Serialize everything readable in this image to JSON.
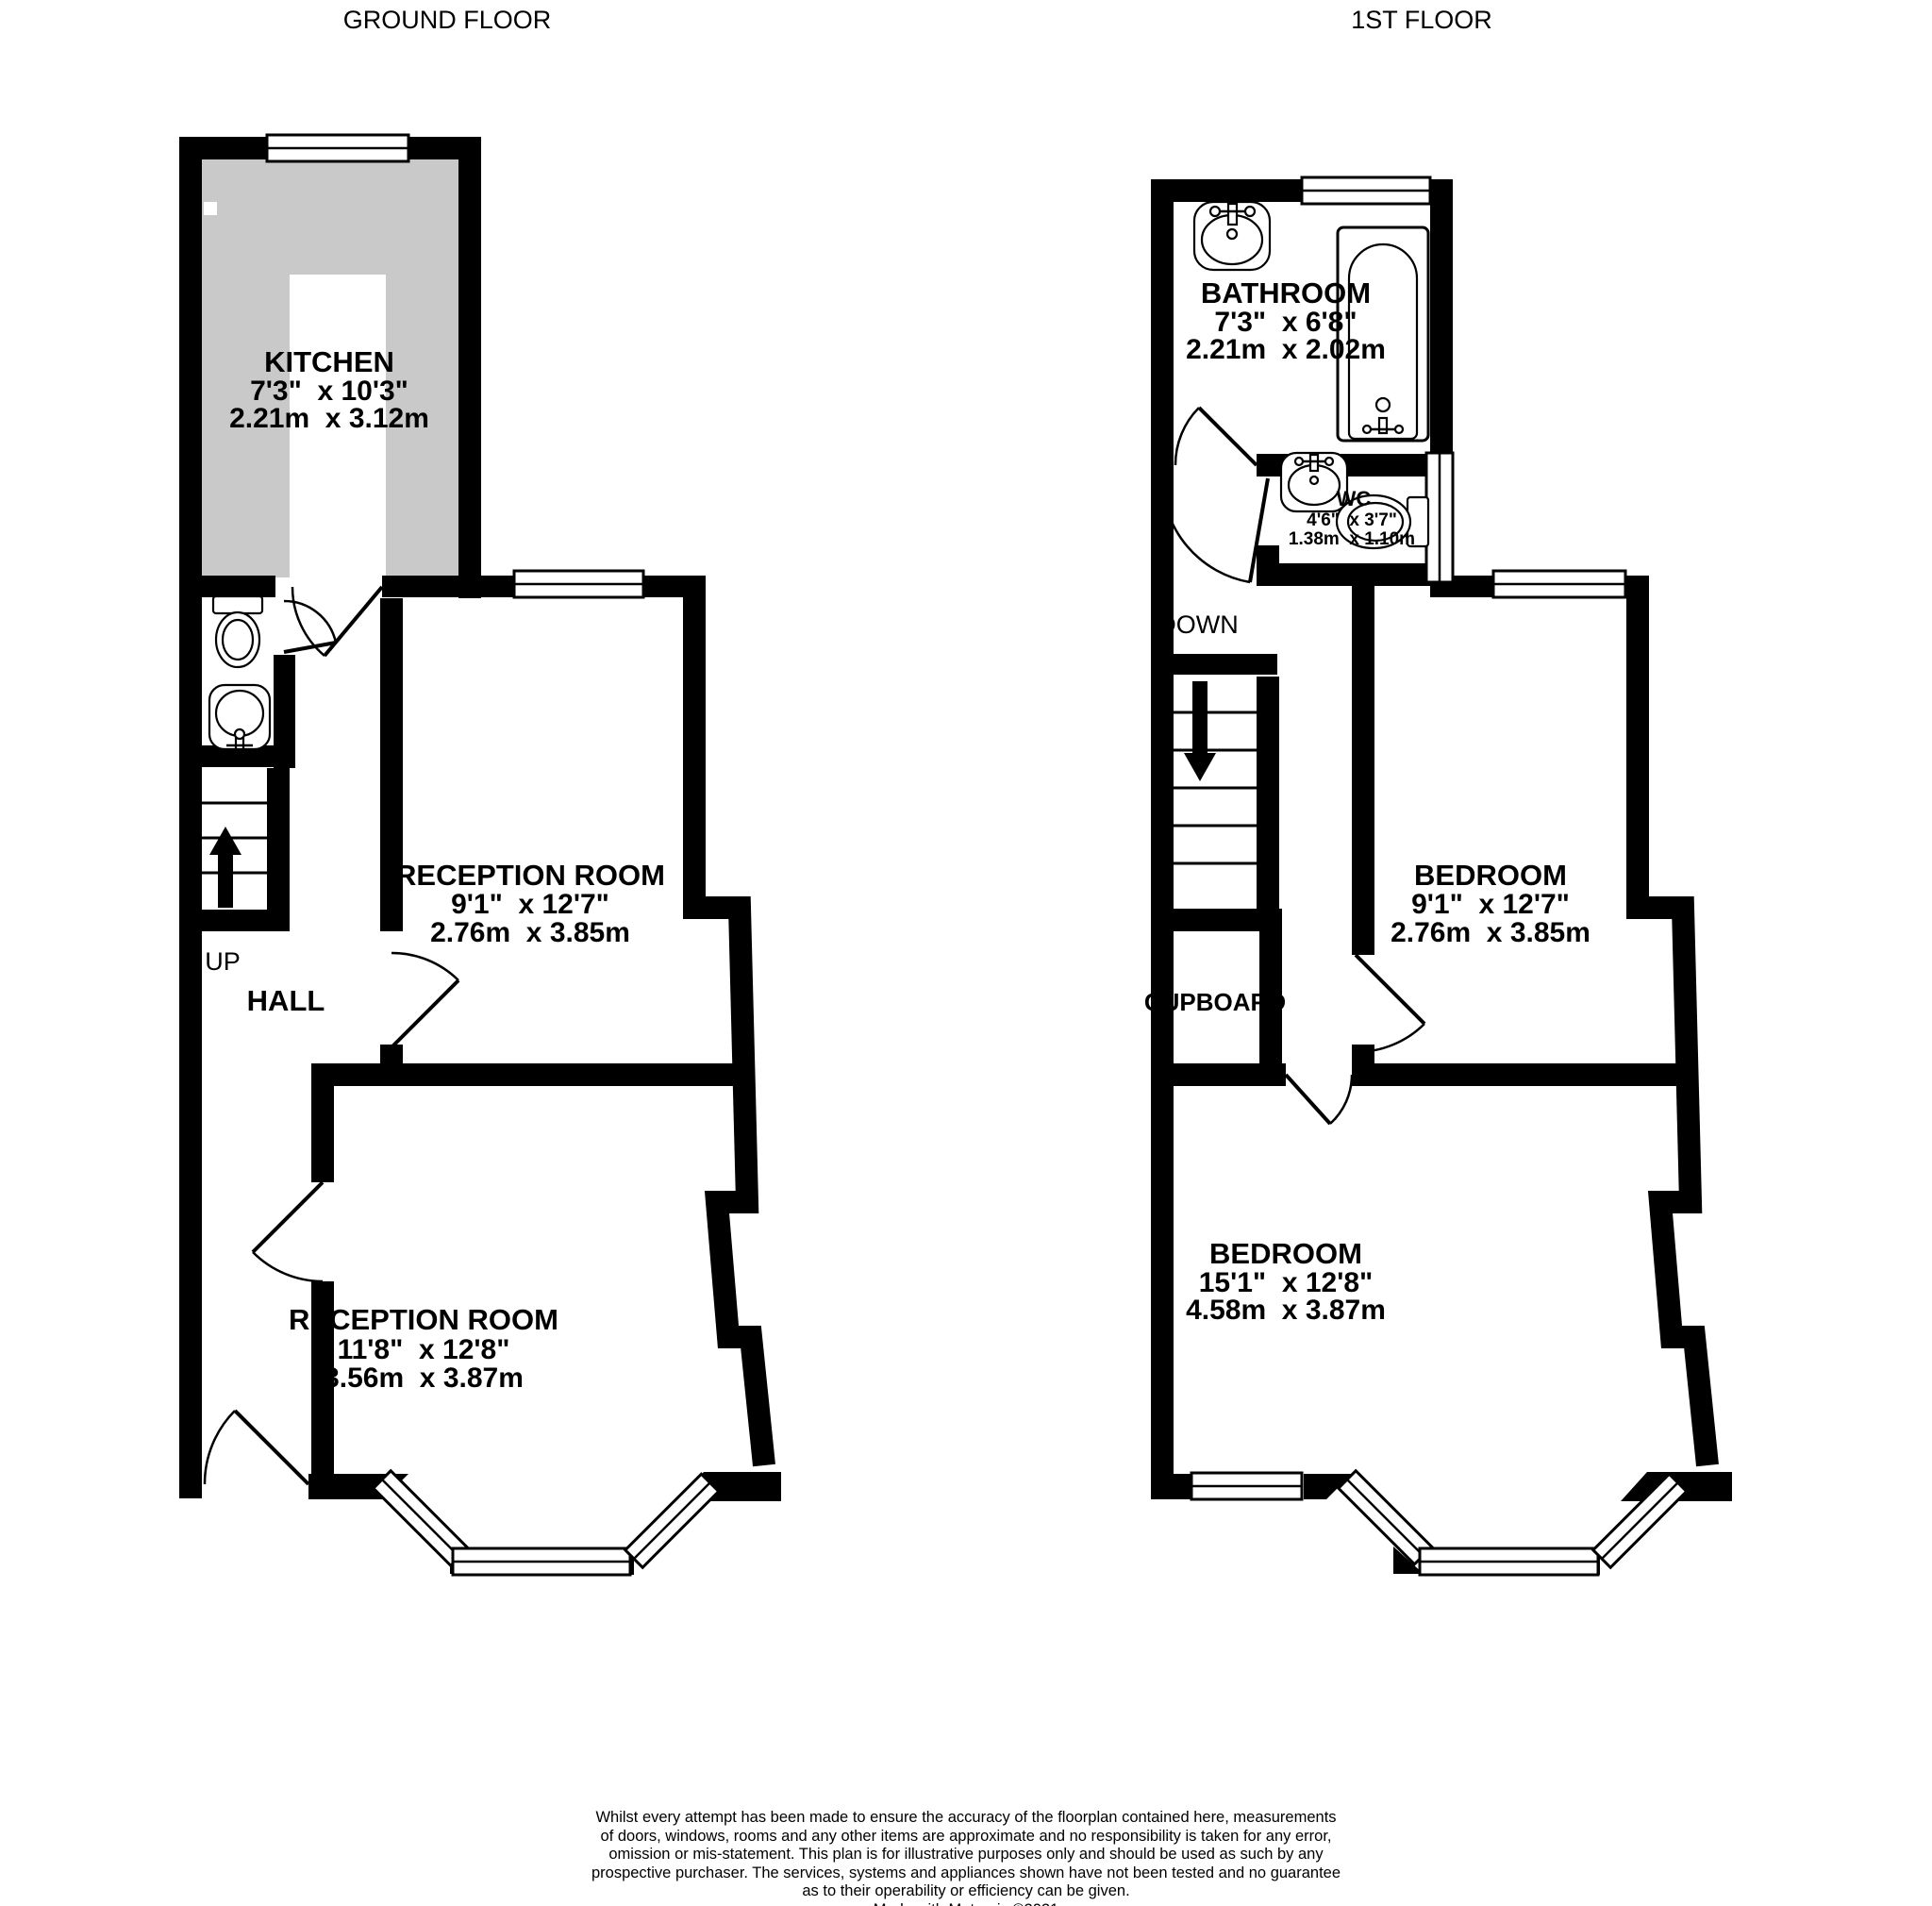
{
  "titles": {
    "ground": "GROUND FLOOR",
    "first": "1ST FLOOR"
  },
  "ground_floor": {
    "kitchen": {
      "name": "KITCHEN",
      "imperial": "7'3\"  x 10'3\"",
      "metric": "2.21m  x 3.12m"
    },
    "reception1": {
      "name": "RECEPTION ROOM",
      "imperial": "9'1\"  x 12'7\"",
      "metric": "2.76m  x 3.85m"
    },
    "reception2": {
      "name": "RECEPTION ROOM",
      "imperial": "11'8\"  x 12'8\"",
      "metric": "3.56m  x 3.87m"
    },
    "hall_label": "HALL",
    "up_label": "UP"
  },
  "first_floor": {
    "bathroom": {
      "name": "BATHROOM",
      "imperial": "7'3\"  x 6'8\"",
      "metric": "2.21m  x 2.02m"
    },
    "wc": {
      "name": "WC",
      "imperial": "4'6\"  x 3'7\"",
      "metric": "1.38m  x 1.10m"
    },
    "bedroom1": {
      "name": "BEDROOM",
      "imperial": "9'1\"  x 12'7\"",
      "metric": "2.76m  x 3.85m"
    },
    "bedroom2": {
      "name": "BEDROOM",
      "imperial": "15'1\"  x 12'8\"",
      "metric": "4.58m  x 3.87m"
    },
    "down_label": "DOWN",
    "cupboard_label": "CUPBOARD"
  },
  "footer": {
    "disclaimer_lines": [
      "Whilst every attempt has been made to ensure the accuracy of the floorplan contained here, measurements",
      "of doors, windows, rooms and any other items are approximate and no responsibility is taken for any error,",
      "omission or mis-statement. This plan is for illustrative purposes only and should be used as such by any",
      "prospective purchaser. The services, systems and appliances shown have not been tested and no guarantee",
      "as to their operability or efficiency can be given."
    ],
    "credit": "Made with Metropix ©2021"
  }
}
